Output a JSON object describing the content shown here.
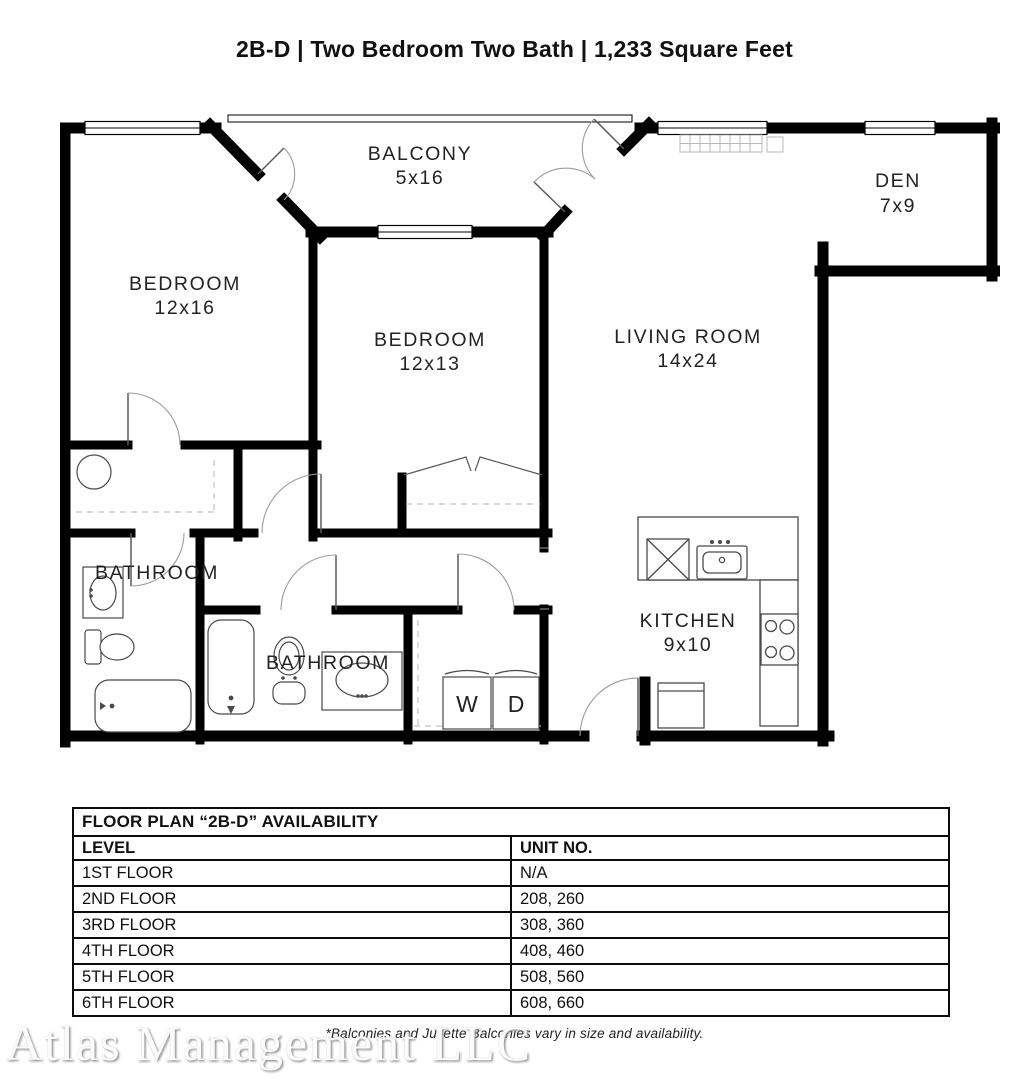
{
  "page": {
    "title": "2B-D | Two Bedroom Two Bath | 1,233 Square Feet"
  },
  "floor_plan": {
    "balcony": {
      "name": "BALCONY",
      "dims": "5x16"
    },
    "den": {
      "name": "DEN",
      "dims": "7x9"
    },
    "bedroom1": {
      "name": "BEDROOM",
      "dims": "12x16"
    },
    "bedroom2": {
      "name": "BEDROOM",
      "dims": "12x13"
    },
    "living_room": {
      "name": "LIVING ROOM",
      "dims": "14x24"
    },
    "bathroom1": {
      "name": "BATHROOM"
    },
    "bathroom2": {
      "name": "BATHROOM"
    },
    "kitchen": {
      "name": "KITCHEN",
      "dims": "9x10"
    },
    "washer": "W",
    "dryer": "D"
  },
  "availability_table": {
    "title": "FLOOR PLAN “2B-D” AVAILABILITY",
    "columns": {
      "level": "LEVEL",
      "unit": "UNIT NO."
    },
    "rows": [
      {
        "level": "1ST FLOOR",
        "units": "N/A"
      },
      {
        "level": "2ND FLOOR",
        "units": "208, 260"
      },
      {
        "level": "3RD FLOOR",
        "units": "308, 360"
      },
      {
        "level": "4TH FLOOR",
        "units": "408, 460"
      },
      {
        "level": "5TH FLOOR",
        "units": "508, 560"
      },
      {
        "level": "6TH FLOOR",
        "units": "608, 660"
      }
    ]
  },
  "footnote": "*Balconies and Juliette Balconies vary in size and availability.",
  "watermark": "Atlas Management LLC"
}
